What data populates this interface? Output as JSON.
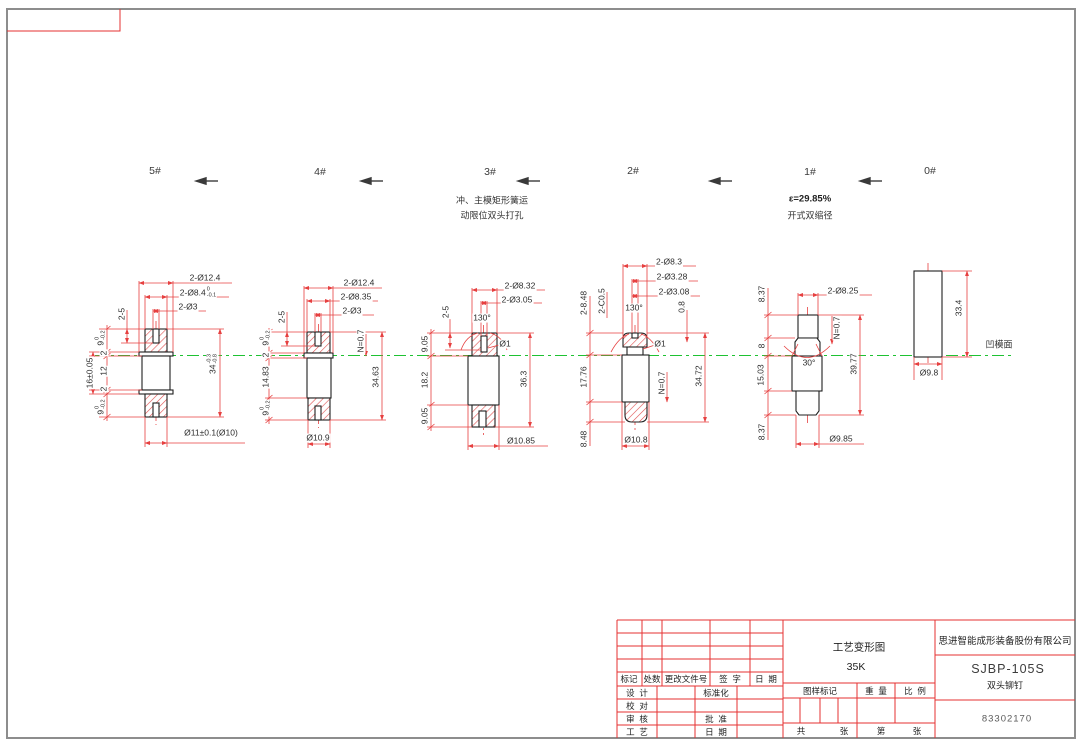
{
  "colors": {
    "dimension_red": "#e64040",
    "outline_black": "#1f1f1f",
    "centerline_green": "#1ec232",
    "titleblock_red": "#e63232"
  },
  "stages": [
    {
      "label": "5#"
    },
    {
      "label": "4#"
    },
    {
      "label": "3#",
      "note_line1": "冲、主模矩形簧运",
      "note_line2": "动限位双头打孔"
    },
    {
      "label": "2#"
    },
    {
      "label": "1#",
      "note_line1": "ε=29.85%",
      "note_line2": "开式双缩径"
    },
    {
      "label": "0#"
    }
  ],
  "die_face_label": "凹模面",
  "dim_labels": [
    {
      "t": "2-Ø12.4",
      "x": 205,
      "y": 278
    },
    {
      "t": "2-Ø8.4",
      "tt": "0",
      "tb": "-0.1",
      "x": 198,
      "y": 293
    },
    {
      "t": "2-Ø3",
      "x": 188,
      "y": 307
    },
    {
      "t": "2-5",
      "x": 122,
      "y": 314,
      "r": 1
    },
    {
      "t": "9",
      "tt": "0",
      "tb": "-0.2",
      "x": 101,
      "y": 338,
      "r": 1
    },
    {
      "t": "2",
      "x": 104,
      "y": 353,
      "r": 1
    },
    {
      "t": "12",
      "x": 104,
      "y": 371,
      "r": 1
    },
    {
      "t": "2",
      "x": 104,
      "y": 389,
      "r": 1
    },
    {
      "t": "9",
      "tt": "0",
      "tb": "-0.2",
      "x": 101,
      "y": 407,
      "r": 1
    },
    {
      "t": "16±0.05",
      "x": 90,
      "y": 373,
      "r": 1
    },
    {
      "t": "34",
      "tt": "-0.3",
      "tb": "-0.8",
      "x": 213,
      "y": 364,
      "r": 1
    },
    {
      "t": "Ø11±0.1(Ø10)",
      "x": 211,
      "y": 433
    },
    {
      "t": "2-Ø12.4",
      "x": 359,
      "y": 283
    },
    {
      "t": "2-Ø8.35",
      "x": 356,
      "y": 297
    },
    {
      "t": "2-Ø3",
      "x": 352,
      "y": 311
    },
    {
      "t": "2-5",
      "x": 282,
      "y": 317,
      "r": 1
    },
    {
      "t": "9",
      "tt": "0",
      "tb": "-0.2",
      "x": 266,
      "y": 338,
      "r": 1
    },
    {
      "t": "2",
      "x": 266,
      "y": 355,
      "r": 1
    },
    {
      "t": "14.83",
      "x": 266,
      "y": 377,
      "r": 1
    },
    {
      "t": "9",
      "tt": "0",
      "tb": "-0.2",
      "x": 266,
      "y": 408,
      "r": 1
    },
    {
      "t": "N=0.7",
      "x": 361,
      "y": 341,
      "r": 1
    },
    {
      "t": "34.63",
      "x": 376,
      "y": 377,
      "r": 1
    },
    {
      "t": "Ø10.9",
      "x": 318,
      "y": 438
    },
    {
      "t": "2-Ø8.32",
      "x": 520,
      "y": 286
    },
    {
      "t": "2-Ø3.05",
      "x": 517,
      "y": 300
    },
    {
      "t": "2-5",
      "x": 446,
      "y": 312,
      "r": 1
    },
    {
      "t": "130°",
      "x": 482,
      "y": 318
    },
    {
      "t": "Ø1",
      "x": 505,
      "y": 344
    },
    {
      "t": "9.05",
      "x": 425,
      "y": 344,
      "r": 1
    },
    {
      "t": "18.2",
      "x": 425,
      "y": 380,
      "r": 1
    },
    {
      "t": "9.05",
      "x": 425,
      "y": 416,
      "r": 1
    },
    {
      "t": "36.3",
      "x": 524,
      "y": 379,
      "r": 1
    },
    {
      "t": "Ø10.85",
      "x": 521,
      "y": 441
    },
    {
      "t": "2-Ø8.3",
      "x": 669,
      "y": 262
    },
    {
      "t": "2-Ø3.28",
      "x": 672,
      "y": 277
    },
    {
      "t": "2-Ø3.08",
      "x": 674,
      "y": 292
    },
    {
      "t": "2-C0.5",
      "x": 602,
      "y": 301,
      "r": 1
    },
    {
      "t": "2-8.48",
      "x": 584,
      "y": 303,
      "r": 1
    },
    {
      "t": "130°",
      "x": 634,
      "y": 308
    },
    {
      "t": "0.8",
      "x": 682,
      "y": 307,
      "r": 1
    },
    {
      "t": "Ø1",
      "x": 660,
      "y": 344
    },
    {
      "t": "17.76",
      "x": 584,
      "y": 377,
      "r": 1
    },
    {
      "t": "8.48",
      "x": 584,
      "y": 439,
      "r": 1
    },
    {
      "t": "N=0.7",
      "x": 662,
      "y": 383,
      "r": 1
    },
    {
      "t": "34.72",
      "x": 699,
      "y": 376,
      "r": 1
    },
    {
      "t": "Ø10.8",
      "x": 636,
      "y": 440
    },
    {
      "t": "2-Ø8.25",
      "x": 843,
      "y": 291
    },
    {
      "t": "8.37",
      "x": 762,
      "y": 294,
      "r": 1
    },
    {
      "t": "8",
      "x": 762,
      "y": 346,
      "r": 1
    },
    {
      "t": "15.03",
      "x": 761,
      "y": 375,
      "r": 1
    },
    {
      "t": "8.37",
      "x": 762,
      "y": 432,
      "r": 1
    },
    {
      "t": "30°",
      "x": 809,
      "y": 363
    },
    {
      "t": "N=0.7",
      "x": 837,
      "y": 328,
      "r": 1
    },
    {
      "t": "39.77",
      "x": 854,
      "y": 364,
      "r": 1
    },
    {
      "t": "Ø9.85",
      "x": 841,
      "y": 439
    },
    {
      "t": "33.4",
      "x": 959,
      "y": 308,
      "r": 1
    },
    {
      "t": "Ø9.8",
      "x": 929,
      "y": 373
    }
  ],
  "title_block": {
    "doc_title": "工艺变形图",
    "doc_subtitle": "35K",
    "company": "思进智能成形装备股份有限公司",
    "model": "SJBP-105S",
    "part_name": "双头铆钉",
    "drawing_no": "83302170",
    "rev": {
      "mark": "标记",
      "count": "处数",
      "file_no": "更改文件号",
      "sign": "签  字",
      "date": "日  期"
    },
    "rows": {
      "design": "设  计",
      "standardize": "标准化",
      "proofread": "校  对",
      "review": "审  核",
      "approve": "批  准",
      "craft": "工  艺",
      "date": "日  期"
    },
    "mark_row": {
      "mark": "图样标记",
      "weight": "重  量",
      "scale": "比  例"
    },
    "pages": {
      "total": "共",
      "sheet1": "张",
      "page": "第",
      "sheet2": "张"
    }
  }
}
